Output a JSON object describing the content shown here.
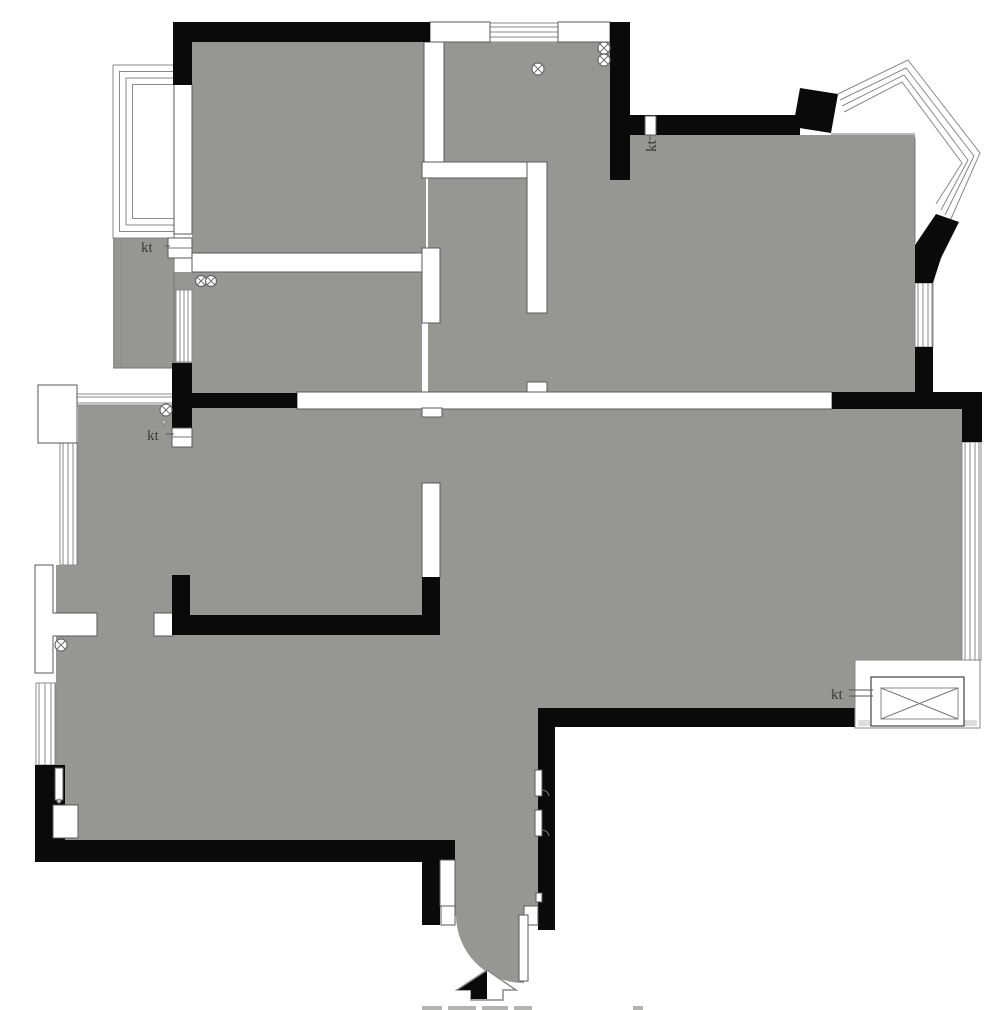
{
  "labels": {
    "ac_unit": "kt"
  },
  "colors": {
    "floor": "#969692",
    "wall": "#0a0a0a",
    "outline": "#777777",
    "window-line": "#8a8a8a",
    "label": "#3a3a3a",
    "bg": "#ffffff"
  },
  "icons": {
    "entrance_arrow": "up-arrow-half-filled",
    "fixture_symbol": "circled-x",
    "ac_outdoor_unit": "box-with-diagonal-cross",
    "door_swing": "quarter-arc"
  }
}
